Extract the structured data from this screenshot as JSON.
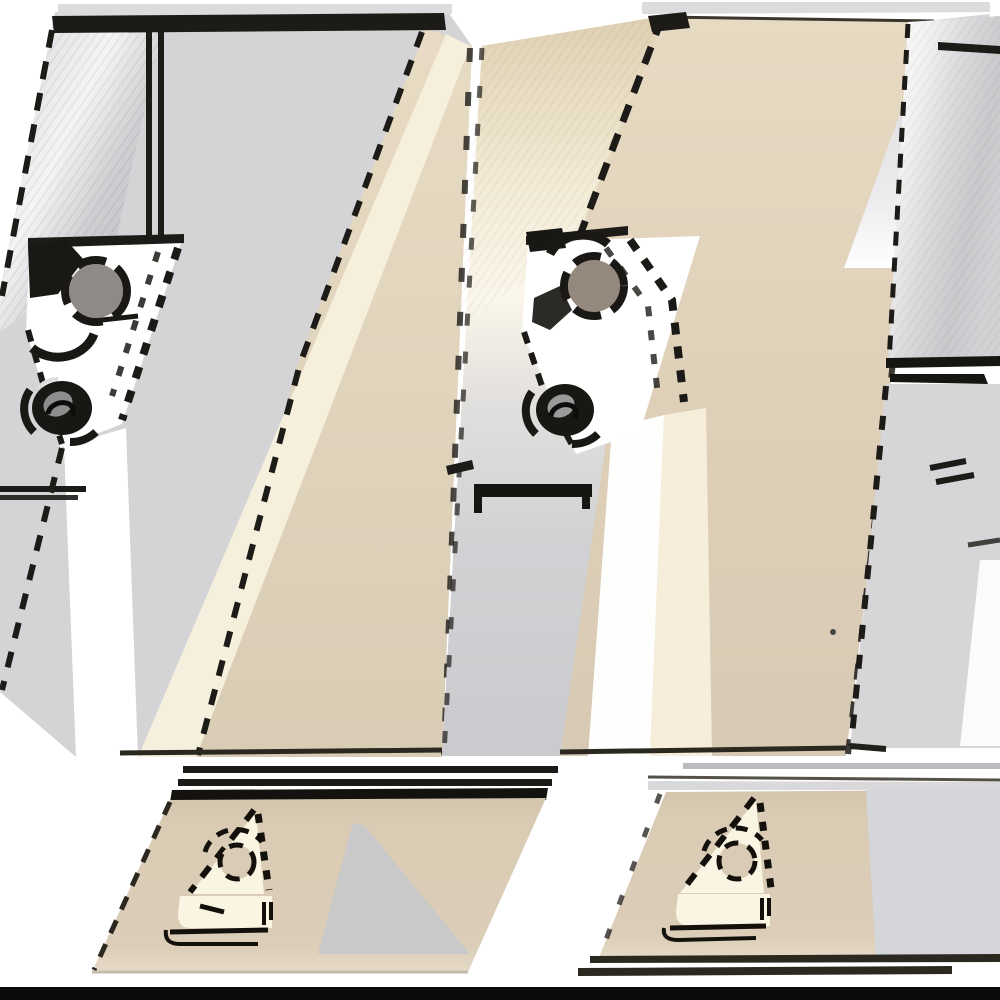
{
  "scene": {
    "kind": "product-photo",
    "subject": "indexable-lathe-turning-tool-holders",
    "objects": [
      "turning-tool-holder-left",
      "turning-tool-holder-middle",
      "turning-tool-holder-right-partial",
      "insert-pocket-closeup-left",
      "insert-pocket-closeup-right"
    ],
    "tool_count": 3,
    "closeup_count": 2
  },
  "palette": {
    "bg": "#ffffff",
    "outline": "#1d1b17",
    "deep_black": "#0c0b0a",
    "steel_light": "#d5d4d7",
    "steel_body": "#d4d3d6",
    "steel_body3": "#d6d5d8",
    "cap_gray": "#dcdbdd",
    "tan": "#d9cdb7",
    "cream": "#f7f0dd",
    "cream_band": "#f6eedb",
    "panel_tan": "#d8cab3",
    "panel_gray": "#d4d6d9",
    "strip_gray": "#d9d9db",
    "sep_gray": "#bcbcc0",
    "shadow_gray": "#c5c8ce",
    "screw_gray": "#8e8b87",
    "screw_brown": "#94897c",
    "screw_core": "#8d8d8d",
    "lineart_cream": "#faf4e3",
    "hole_tan": "#d9cbb5",
    "dark_line": "#2b2820",
    "white": "#ffffff"
  }
}
